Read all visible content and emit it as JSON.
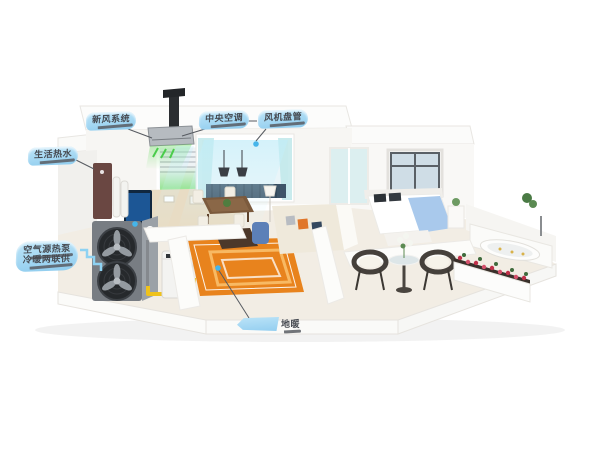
{
  "canvas": {
    "width": 600,
    "height": 450,
    "background": "#ffffff"
  },
  "callouts": {
    "fresh_air": {
      "label": "新风系统"
    },
    "central_ac": {
      "label": "中央空调"
    },
    "fan_coil": {
      "label": "风机盘管"
    },
    "hot_water": {
      "label": "生活热水"
    },
    "heat_pump": {
      "label": "空气源热泵",
      "sublabel": "冷暖两联供"
    },
    "floor_heating": {
      "label": "地暖"
    }
  },
  "colors": {
    "callout_bubble": "#a5d8f3",
    "callout_text": "#474b52",
    "pointer_line": "#565a60",
    "pointer_dot": "#45b5ea",
    "pipe_yellow": "#efc21c",
    "rug_orange": "#e8831d",
    "fresh_air_green": "#46c94a",
    "air_flow_cyan": "#bfeffc",
    "heat_pump_body": "#787d83"
  }
}
